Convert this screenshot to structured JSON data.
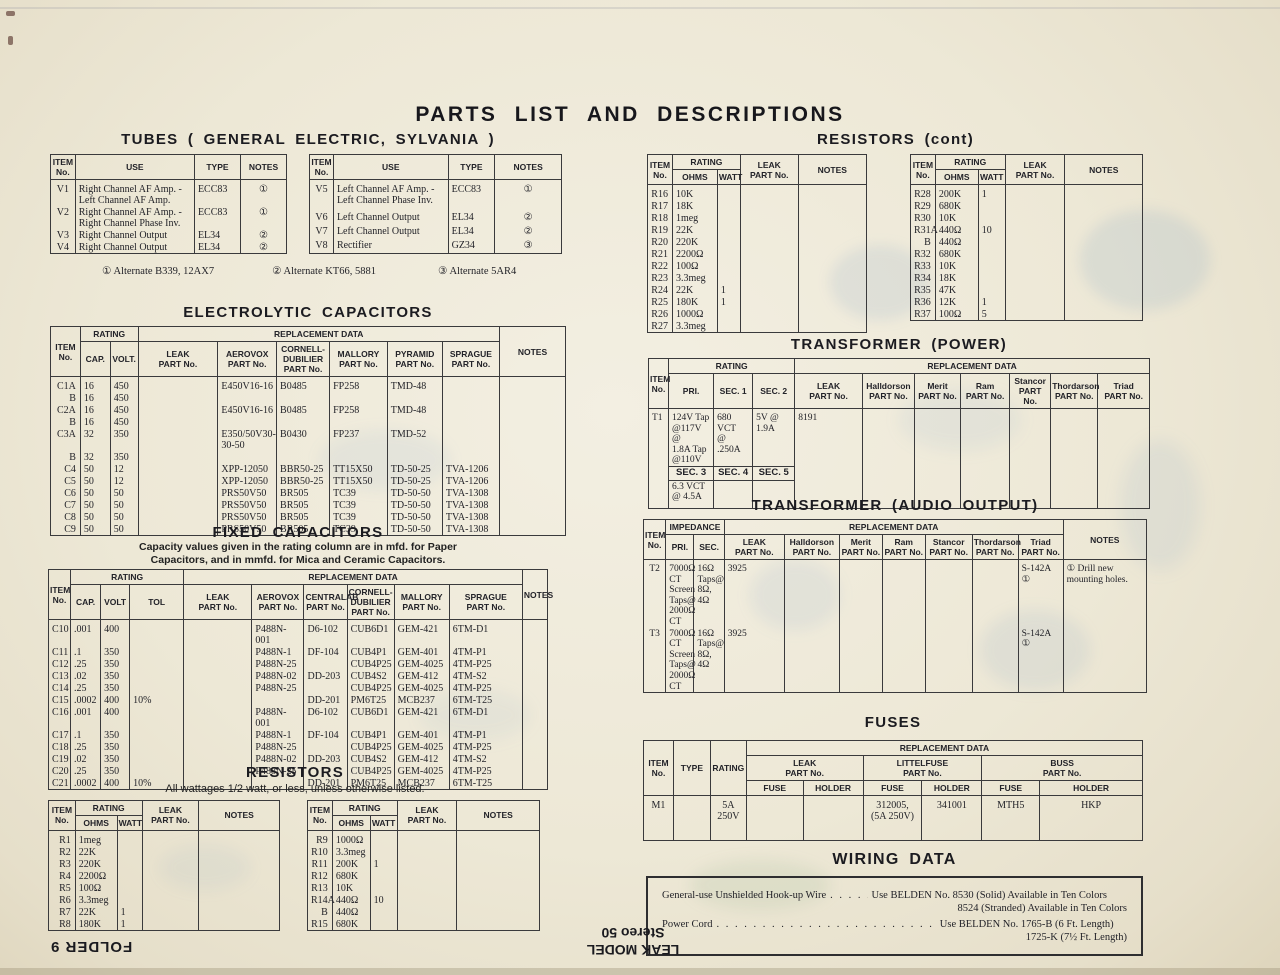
{
  "colors": {
    "paper": "#ede8d6",
    "ink": "#26262b",
    "table_line": "#3a3a3c"
  },
  "page": {
    "title": "PARTS LIST AND DESCRIPTIONS",
    "footer_folder": "FOLDER 9",
    "footer_model_line1": "LEAK MODEL",
    "footer_model_line2": "Stereo 50"
  },
  "common": {
    "item_header": "ITEM\nNo.",
    "rating_header": "RATING",
    "repl_header": "REPLACEMENT DATA",
    "notes_header": "NOTES",
    "leak_header": "LEAK\nPART No.",
    "ohms_header": "OHMS",
    "watt_header": "WATT",
    "fuse_header": "FUSE",
    "holder_header": "HOLDER"
  },
  "tubes": {
    "heading": "TUBES ( GENERAL ELECTRIC, SYLVANIA )",
    "use_header": "USE",
    "type_header": "TYPE",
    "left_rows": [
      [
        "V1",
        "Right Channel AF Amp. -\nLeft Channel AF Amp.",
        "ECC83",
        "①"
      ],
      [
        "V2",
        "Right Channel AF Amp. -\nRight Channel Phase Inv.",
        "ECC83",
        "①"
      ],
      [
        "V3",
        "Right Channel Output",
        "EL34",
        "②"
      ],
      [
        "V4",
        "Right Channel Output",
        "EL34",
        "②"
      ]
    ],
    "right_rows": [
      [
        "V5",
        "Left Channel AF Amp. -\nLeft Channel Phase Inv.",
        "ECC83",
        "①"
      ],
      [
        "V6",
        "Left Channel Output",
        "EL34",
        "②"
      ],
      [
        "V7",
        "Left Channel Output",
        "EL34",
        "②"
      ],
      [
        "V8",
        "Rectifier",
        "GZ34",
        "③"
      ]
    ],
    "footnote1": "① Alternate B339, 12AX7",
    "footnote2": "② Alternate KT66, 5881",
    "footnote3": "③ Alternate 5AR4"
  },
  "electrolytic": {
    "heading": "ELECTROLYTIC CAPACITORS",
    "cap_header": "CAP.",
    "volt_header": "VOLT.",
    "aerovox_header": "AEROVOX\nPART No.",
    "cd_header": "CORNELL-\nDUBILIER\nPART No.",
    "mallory_header": "MALLORY\nPART No.",
    "pyramid_header": "PYRAMID\nPART No.",
    "sprague_header": "SPRAGUE\nPART No.",
    "rows": [
      [
        "C1A",
        "16",
        "450",
        "",
        "E450V16-16",
        "B0485",
        "FP258",
        "TMD-48",
        "",
        ""
      ],
      [
        "B",
        "16",
        "450",
        "",
        "",
        "",
        "",
        "",
        "",
        ""
      ],
      [
        "C2A",
        "16",
        "450",
        "",
        "E450V16-16",
        "B0485",
        "FP258",
        "TMD-48",
        "",
        ""
      ],
      [
        "B",
        "16",
        "450",
        "",
        "",
        "",
        "",
        "",
        "",
        ""
      ],
      [
        "C3A",
        "32",
        "350",
        "",
        "E350/50V30-30-50",
        "B0430",
        "FP237",
        "TMD-52",
        "",
        ""
      ],
      [
        "B",
        "32",
        "350",
        "",
        "",
        "",
        "",
        "",
        "",
        ""
      ],
      [
        "C4",
        "50",
        "12",
        "",
        "XPP-12050",
        "BBR50-25",
        "TT15X50",
        "TD-50-25",
        "TVA-1206",
        ""
      ],
      [
        "C5",
        "50",
        "12",
        "",
        "XPP-12050",
        "BBR50-25",
        "TT15X50",
        "TD-50-25",
        "TVA-1206",
        ""
      ],
      [
        "C6",
        "50",
        "50",
        "",
        "PRS50V50",
        "BR505",
        "TC39",
        "TD-50-50",
        "TVA-1308",
        ""
      ],
      [
        "C7",
        "50",
        "50",
        "",
        "PRS50V50",
        "BR505",
        "TC39",
        "TD-50-50",
        "TVA-1308",
        ""
      ],
      [
        "C8",
        "50",
        "50",
        "",
        "PRS50V50",
        "BR505",
        "TC39",
        "TD-50-50",
        "TVA-1308",
        ""
      ],
      [
        "C9",
        "50",
        "50",
        "",
        "PRS50V50",
        "BR505",
        "TC39",
        "TD-50-50",
        "TVA-1308",
        ""
      ]
    ]
  },
  "fixed": {
    "heading": "FIXED CAPACITORS",
    "subtitle_line1": "Capacity values given in the rating column are in mfd. for Paper",
    "subtitle_line2": "Capacitors, and in mmfd. for Mica and Ceramic Capacitors.",
    "cap_header": "CAP.",
    "volt_header": "VOLT",
    "tol_header": "TOL",
    "aerovox_header": "AEROVOX\nPART No.",
    "centralab_header": "CENTRALAB\nPART No.",
    "cd_header": "CORNELL-\nDUBILIER\nPART No.",
    "mallory_header": "MALLORY\nPART No.",
    "sprague_header": "SPRAGUE\nPART No.",
    "rows": [
      [
        "C10",
        ".001",
        "400",
        "",
        "",
        "P488N-001",
        "D6-102",
        "CUB6D1",
        "GEM-421",
        "6TM-D1",
        ""
      ],
      [
        "C11",
        ".1",
        "350",
        "",
        "",
        "P488N-1",
        "DF-104",
        "CUB4P1",
        "GEM-401",
        "4TM-P1",
        ""
      ],
      [
        "C12",
        ".25",
        "350",
        "",
        "",
        "P488N-25",
        "",
        "CUB4P25",
        "GEM-4025",
        "4TM-P25",
        ""
      ],
      [
        "C13",
        ".02",
        "350",
        "",
        "",
        "P488N-02",
        "DD-203",
        "CUB4S2",
        "GEM-412",
        "4TM-S2",
        ""
      ],
      [
        "C14",
        ".25",
        "350",
        "",
        "",
        "P488N-25",
        "",
        "CUB4P25",
        "GEM-4025",
        "4TM-P25",
        ""
      ],
      [
        "C15",
        ".0002",
        "400",
        "10%",
        "",
        "",
        "DD-201",
        "PM6T25",
        "MCB237",
        "6TM-T25",
        ""
      ],
      [
        "C16",
        ".001",
        "400",
        "",
        "",
        "P488N-001",
        "D6-102",
        "CUB6D1",
        "GEM-421",
        "6TM-D1",
        ""
      ],
      [
        "C17",
        ".1",
        "350",
        "",
        "",
        "P488N-1",
        "DF-104",
        "CUB4P1",
        "GEM-401",
        "4TM-P1",
        ""
      ],
      [
        "C18",
        ".25",
        "350",
        "",
        "",
        "P488N-25",
        "",
        "CUB4P25",
        "GEM-4025",
        "4TM-P25",
        ""
      ],
      [
        "C19",
        ".02",
        "350",
        "",
        "",
        "P488N-02",
        "DD-203",
        "CUB4S2",
        "GEM-412",
        "4TM-S2",
        ""
      ],
      [
        "C20",
        ".25",
        "350",
        "",
        "",
        "P488N-25",
        "",
        "CUB4P25",
        "GEM-4025",
        "4TM-P25",
        ""
      ],
      [
        "C21",
        ".0002",
        "400",
        "10%",
        "",
        "",
        "DD-201",
        "PM6T25",
        "MCB237",
        "6TM-T25",
        ""
      ]
    ]
  },
  "resistors": {
    "heading": "RESISTORS",
    "subtitle": "All wattages 1/2 watt, or less, unless otherwise listed.",
    "left_rows": [
      [
        "R1",
        "1meg",
        "",
        "",
        ""
      ],
      [
        "R2",
        "22K",
        "",
        "",
        ""
      ],
      [
        "R3",
        "220K",
        "",
        "",
        ""
      ],
      [
        "R4",
        "2200Ω",
        "",
        "",
        ""
      ],
      [
        "R5",
        "100Ω",
        "",
        "",
        ""
      ],
      [
        "R6",
        "3.3meg",
        "",
        "",
        ""
      ],
      [
        "R7",
        "22K",
        "1",
        "",
        ""
      ],
      [
        "R8",
        "180K",
        "1",
        "",
        ""
      ]
    ],
    "right_rows": [
      [
        "R9",
        "1000Ω",
        "",
        "",
        ""
      ],
      [
        "R10",
        "3.3meg",
        "",
        "",
        ""
      ],
      [
        "R11",
        "200K",
        "1",
        "",
        ""
      ],
      [
        "R12",
        "680K",
        "",
        "",
        ""
      ],
      [
        "R13",
        "10K",
        "",
        "",
        ""
      ],
      [
        "R14A",
        "440Ω",
        "10",
        "",
        ""
      ],
      [
        "B",
        "440Ω",
        "",
        "",
        ""
      ],
      [
        "R15",
        "680K",
        "",
        "",
        ""
      ]
    ]
  },
  "resistors_cont": {
    "heading": "RESISTORS (cont)",
    "left_rows": [
      [
        "R16",
        "10K",
        "",
        "",
        ""
      ],
      [
        "R17",
        "18K",
        "",
        "",
        ""
      ],
      [
        "R18",
        "1meg",
        "",
        "",
        ""
      ],
      [
        "R19",
        "22K",
        "",
        "",
        ""
      ],
      [
        "R20",
        "220K",
        "",
        "",
        ""
      ],
      [
        "R21",
        "2200Ω",
        "",
        "",
        ""
      ],
      [
        "R22",
        "100Ω",
        "",
        "",
        ""
      ],
      [
        "R23",
        "3.3meg",
        "",
        "",
        ""
      ],
      [
        "R24",
        "22K",
        "1",
        "",
        ""
      ],
      [
        "R25",
        "180K",
        "1",
        "",
        ""
      ],
      [
        "R26",
        "1000Ω",
        "",
        "",
        ""
      ],
      [
        "R27",
        "3.3meg",
        "",
        "",
        ""
      ]
    ],
    "right_rows": [
      [
        "R28",
        "200K",
        "1",
        "",
        ""
      ],
      [
        "R29",
        "680K",
        "",
        "",
        ""
      ],
      [
        "R30",
        "10K",
        "",
        "",
        ""
      ],
      [
        "R31A",
        "440Ω",
        "10",
        "",
        ""
      ],
      [
        "B",
        "440Ω",
        "",
        "",
        ""
      ],
      [
        "R32",
        "680K",
        "",
        "",
        ""
      ],
      [
        "R33",
        "10K",
        "",
        "",
        ""
      ],
      [
        "R34",
        "18K",
        "",
        "",
        ""
      ],
      [
        "R35",
        "47K",
        "",
        "",
        ""
      ],
      [
        "R36",
        "12K",
        "1",
        "",
        ""
      ],
      [
        "R37",
        "100Ω",
        "5",
        "",
        ""
      ]
    ]
  },
  "transformer_power": {
    "heading": "TRANSFORMER (POWER)",
    "pri_header": "PRI.",
    "sec1_header": "SEC. 1",
    "sec2_header": "SEC. 2",
    "halldorson_header": "Halldorson\nPART No.",
    "merit_header": "Merit\nPART No.",
    "ram_header": "Ram\nPART No.",
    "stancor_header": "Stancor\nPART No.",
    "thordarson_header": "Thordarson\nPART No.",
    "triad_header": "Triad\nPART No.",
    "row": {
      "item": "T1",
      "pri": "124V Tap\n@117V @\n1.8A Tap\n@110V",
      "sec1": "680 VCT\n@ .250A",
      "sec2": "5V @\n1.9A",
      "leak": "8191",
      "sec3_label": "SEC. 3",
      "sec4_label": "SEC. 4",
      "sec5_label": "SEC. 5",
      "sec3_val": "6.3 VCT\n@ 4.5A"
    }
  },
  "transformer_audio": {
    "heading": "TRANSFORMER (AUDIO OUTPUT)",
    "impedance_header": "IMPEDANCE",
    "pri_header": "PRI.",
    "sec_header": "SEC.",
    "halldorson_header": "Halldorson\nPART No.",
    "merit_header": "Merit\nPART No.",
    "ram_header": "Ram\nPART No.",
    "stancor_header": "Stancor\nPART No.",
    "thordarson_header": "Thordarson\nPART No.",
    "triad_header": "Triad\nPART No.",
    "rows": [
      [
        "T2",
        "7000Ω\nCT\nScreen\nTaps@\n2000Ω\nCT",
        "16Ω\nTaps@\n8Ω,\n4Ω",
        "3925",
        "",
        "",
        "",
        "",
        "",
        "S-142A ①",
        "① Drill new\nmounting holes."
      ],
      [
        "T3",
        "7000Ω\nCT\nScreen\nTaps@\n2000Ω\nCT",
        "16Ω\nTaps@\n8Ω,\n4Ω",
        "3925",
        "",
        "",
        "",
        "",
        "",
        "S-142A ①",
        ""
      ]
    ]
  },
  "fuses": {
    "heading": "FUSES",
    "type_header": "TYPE",
    "rating_header": "RATING",
    "littelfuse_header": "LITTELFUSE\nPART No.",
    "buss_header": "BUSS\nPART No.",
    "rows": [
      [
        "M1",
        "",
        "5A\n250V",
        "",
        "",
        "312005,\n(5A 250V)",
        "341001",
        "MTH5",
        "HKP"
      ]
    ]
  },
  "wiring": {
    "heading": "WIRING DATA",
    "rows": [
      {
        "label": "General-use Unshielded Hook-up Wire",
        "value1": "Use BELDEN No. 8530 (Solid) Available in Ten Colors",
        "value2": "8524 (Stranded) Available in Ten Colors"
      },
      {
        "label": "Power Cord",
        "value1": "Use BELDEN No. 1765-B (6 Ft. Length)",
        "value2": "1725-K (7½ Ft. Length)"
      }
    ]
  }
}
